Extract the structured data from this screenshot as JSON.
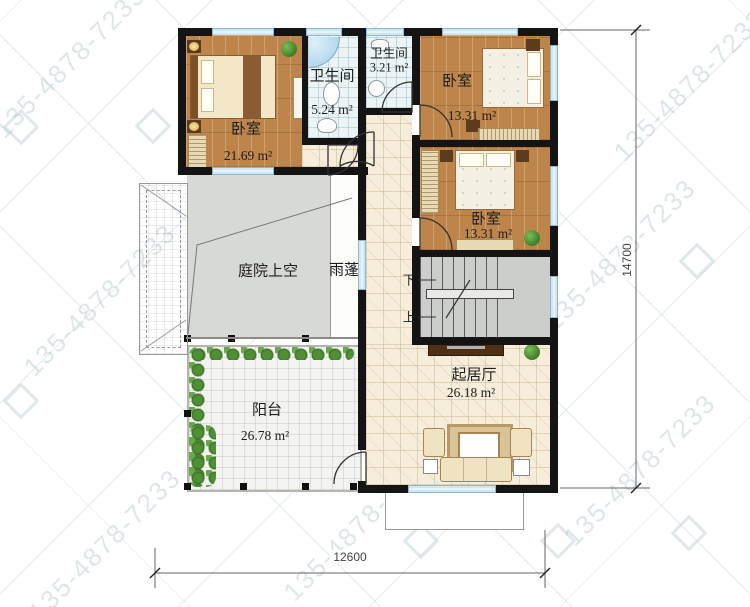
{
  "watermark": {
    "phone": "135-4878-7233"
  },
  "rooms": {
    "bedroom_tl": {
      "name": "卧室",
      "area": "21.69 m²"
    },
    "bath_main": {
      "name": "卫生间",
      "area": "5.24 m²"
    },
    "bath_small": {
      "name": "卫生间",
      "area": "3.21 m²"
    },
    "bedroom_tr": {
      "name": "卧室",
      "area": "13.31 m²"
    },
    "bedroom_mr": {
      "name": "卧室",
      "area": "13.31 m²"
    },
    "courtyard": {
      "name": "庭院上空"
    },
    "canopy": {
      "name": "雨蓬"
    },
    "balcony": {
      "name": "阳台",
      "area": "26.78 m²"
    },
    "living": {
      "name": "起居厅",
      "area": "26.18 m²"
    }
  },
  "stairs": {
    "down": "下",
    "up": "上"
  },
  "dimensions": {
    "bottom": "12600",
    "right": "14700"
  },
  "colors": {
    "wall": "#141414",
    "wood_floor": "#bd854a",
    "bathroom_tile": "#ecf4f6",
    "cream_tile": "#f6eedb",
    "courtyard_gray": "#d7d9d5",
    "window_blue": "#cfe7f2",
    "plant_green": "#4f8f35",
    "watermark_gray": "#a8bec5"
  }
}
